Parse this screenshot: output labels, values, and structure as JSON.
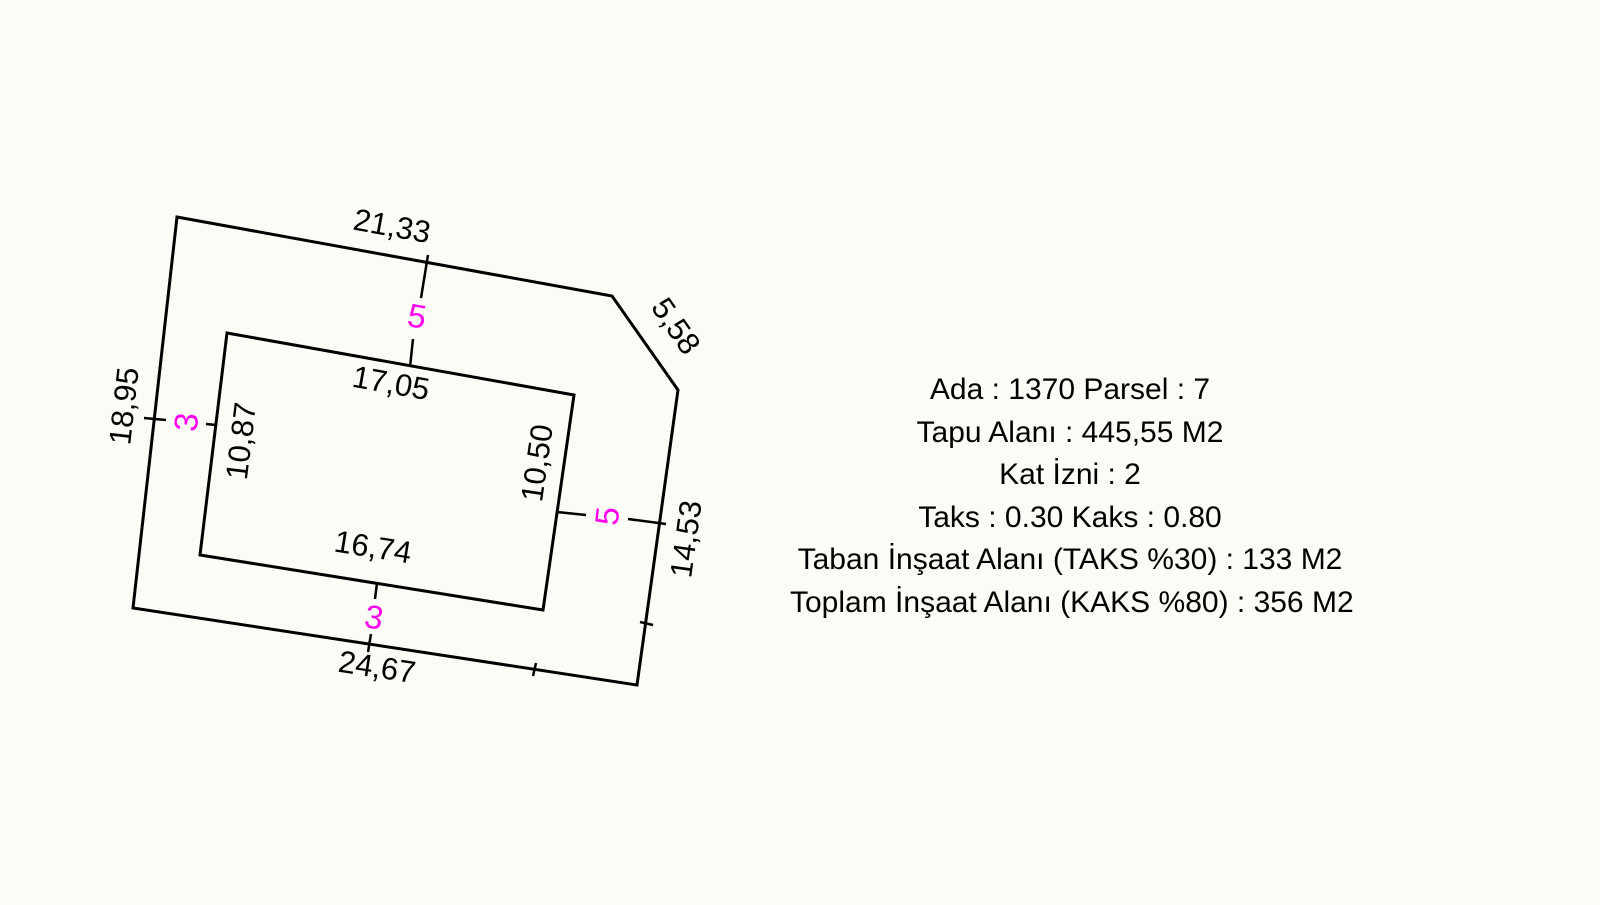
{
  "diagram": {
    "title_hint": "cadastral parcel plan",
    "outer_dims": {
      "top": "21,33",
      "chamfer": "5,58",
      "left": "18,95",
      "right": "14,53",
      "bottom": "24,67"
    },
    "inner_dims": {
      "top": "17,05",
      "left": "10,87",
      "right": "10,50",
      "bottom": "16,74"
    },
    "setbacks": {
      "top": "5",
      "left": "3",
      "right": "5",
      "bottom": "3"
    }
  },
  "info_panel": {
    "lines": [
      "Ada : 1370 Parsel : 7",
      "Tapu Alanı : 445,55 M2",
      "Kat İzni : 2",
      "Taks : 0.30 Kaks : 0.80",
      "Taban İnşaat Alanı (TAKS %30) : 133 M2",
      "Toplam İnşaat Alanı (KAKS %80) : 356 M2"
    ]
  },
  "colors": {
    "background": "#fcfcf7",
    "line": "#000000",
    "setback": "#ff00f0"
  }
}
